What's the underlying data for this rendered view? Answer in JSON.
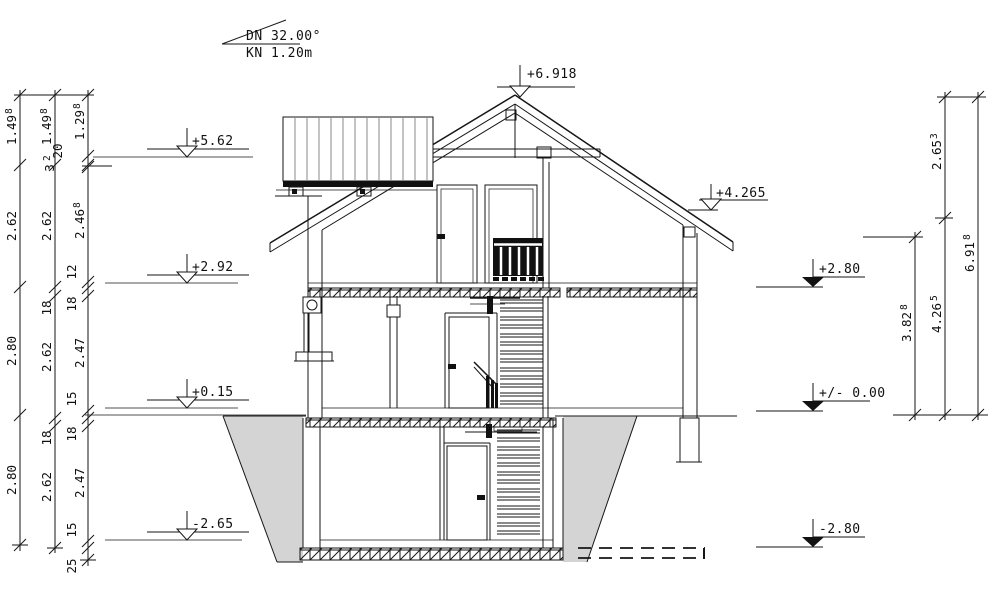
{
  "roof_annotation": {
    "line1": "DN 32.00°",
    "line2": "KN 1.20m"
  },
  "markers": {
    "ridge": "+6.918",
    "left": [
      "+5.62",
      "+2.92",
      "+0.15",
      "-2.65"
    ],
    "right": [
      "+4.265",
      "+2.80",
      "+/- 0.00",
      "-2.80"
    ]
  },
  "dims": {
    "l1": [
      {
        "v": "1.49",
        "s": "8"
      },
      {
        "v": "2.62",
        "s": ""
      },
      {
        "v": "2.80",
        "s": ""
      },
      {
        "v": "2.80",
        "s": ""
      }
    ],
    "l2": [
      {
        "v": "1.49",
        "s": "8"
      },
      {
        "v": "2.62",
        "s": ""
      },
      {
        "v": "18",
        "s": ""
      },
      {
        "v": "2.62",
        "s": ""
      },
      {
        "v": "18",
        "s": ""
      },
      {
        "v": "2.62",
        "s": ""
      }
    ],
    "l3": [
      {
        "v": "1.29",
        "s": "8"
      },
      {
        "v": "20",
        "s": ""
      },
      {
        "v": "3",
        "s": "2"
      },
      {
        "v": "2.46",
        "s": "8"
      },
      {
        "v": "12",
        "s": ""
      },
      {
        "v": "18",
        "s": ""
      },
      {
        "v": "2.47",
        "s": ""
      },
      {
        "v": "15",
        "s": ""
      },
      {
        "v": "18",
        "s": ""
      },
      {
        "v": "2.47",
        "s": ""
      },
      {
        "v": "15",
        "s": ""
      },
      {
        "v": "25",
        "s": ""
      }
    ],
    "r1": [
      {
        "v": "3.82",
        "s": "8"
      }
    ],
    "r2": [
      {
        "v": "2.65",
        "s": "3"
      },
      {
        "v": "4.26",
        "s": "5"
      }
    ],
    "r3": [
      {
        "v": "6.91",
        "s": "8"
      }
    ]
  },
  "colors": {
    "hatch_stroke": "#6e3b4b",
    "ground_fill": "#d4d4d4",
    "line": "#161616"
  }
}
